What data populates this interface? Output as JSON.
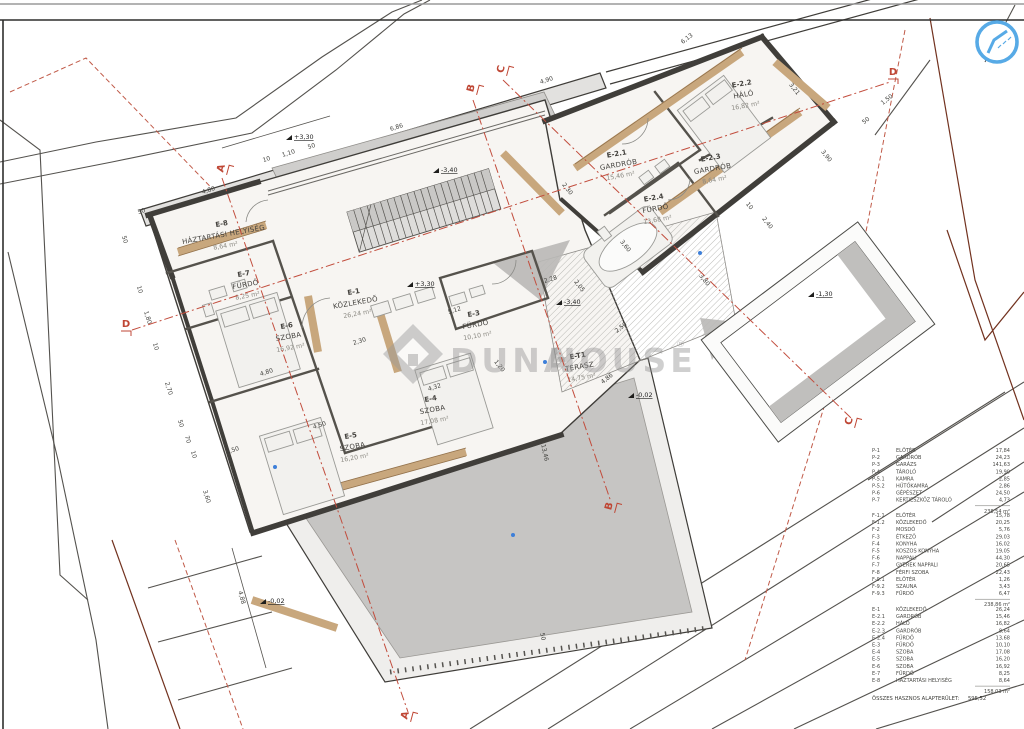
{
  "watermark": {
    "brand_left": "DUNA",
    "brand_right": "HOUSE",
    "reg": "®"
  },
  "plan": {
    "rooms": [
      {
        "id": "E-8",
        "name": "HÁZTARTÁSI HELYISÉG",
        "area": "8,64 m²",
        "x": 222,
        "y": 226,
        "rot": -10
      },
      {
        "id": "E-7",
        "name": "FÜRDŐ",
        "area": "8,25 m²",
        "x": 244,
        "y": 276,
        "rot": -10
      },
      {
        "id": "E-6",
        "name": "SZOBA",
        "area": "16,92 m²",
        "x": 287,
        "y": 328,
        "rot": -10
      },
      {
        "id": "E-1",
        "name": "KÖZLEKEDŐ",
        "area": "26,24 m²",
        "x": 354,
        "y": 294,
        "rot": -10
      },
      {
        "id": "E-3",
        "name": "FÜRDŐ",
        "area": "10,10 m²",
        "x": 474,
        "y": 316,
        "rot": -10
      },
      {
        "id": "E-4",
        "name": "SZOBA",
        "area": "17,08 m²",
        "x": 431,
        "y": 401,
        "rot": -10
      },
      {
        "id": "E-5",
        "name": "SZOBA",
        "area": "16,20 m²",
        "x": 351,
        "y": 438,
        "rot": -10
      },
      {
        "id": "E-2.1",
        "name": "GARDRÓB",
        "area": "15,46 m²",
        "x": 617,
        "y": 156,
        "rot": -10
      },
      {
        "id": "E-2.2",
        "name": "HÁLÓ",
        "area": "16,82 m²",
        "x": 742,
        "y": 86,
        "rot": -10
      },
      {
        "id": "E-2.3",
        "name": "GARDRÓB",
        "area": "8,64 m²",
        "x": 711,
        "y": 160,
        "rot": -10
      },
      {
        "id": "E-2.4",
        "name": "FÜRDŐ",
        "area": "13,68 m²",
        "x": 654,
        "y": 200,
        "rot": -10
      },
      {
        "id": "E-T1",
        "name": "TERASZ",
        "area": "14,75 m²",
        "x": 578,
        "y": 358,
        "rot": -10
      }
    ],
    "dimensions": [
      {
        "t": "4,80",
        "x": 209,
        "y": 192,
        "r": -17
      },
      {
        "t": "50",
        "x": 142,
        "y": 213,
        "r": -17
      },
      {
        "t": "50",
        "x": 123,
        "y": 240,
        "r": 73
      },
      {
        "t": "10",
        "x": 267,
        "y": 161,
        "r": -17
      },
      {
        "t": "1,10",
        "x": 289,
        "y": 155,
        "r": -17
      },
      {
        "t": "50",
        "x": 312,
        "y": 148,
        "r": -17
      },
      {
        "t": "6,86",
        "x": 397,
        "y": 129,
        "r": -17
      },
      {
        "t": "4,90",
        "x": 547,
        "y": 82,
        "r": -17
      },
      {
        "t": "6,13",
        "x": 688,
        "y": 40,
        "r": -38
      },
      {
        "t": "3,21",
        "x": 793,
        "y": 90,
        "r": 52
      },
      {
        "t": "3,90",
        "x": 825,
        "y": 157,
        "r": 52
      },
      {
        "t": "1,50",
        "x": 888,
        "y": 101,
        "r": -38
      },
      {
        "t": "50",
        "x": 867,
        "y": 122,
        "r": -38
      },
      {
        "t": "2,40",
        "x": 766,
        "y": 224,
        "r": 52
      },
      {
        "t": "10",
        "x": 748,
        "y": 207,
        "r": 52
      },
      {
        "t": "2,30",
        "x": 566,
        "y": 190,
        "r": 52
      },
      {
        "t": "3,60",
        "x": 624,
        "y": 247,
        "r": 52
      },
      {
        "t": "2,50",
        "x": 622,
        "y": 329,
        "r": -38
      },
      {
        "t": "2,28",
        "x": 551,
        "y": 281,
        "r": -17
      },
      {
        "t": "2,05",
        "x": 578,
        "y": 287,
        "r": 52
      },
      {
        "t": "3,80",
        "x": 703,
        "y": 281,
        "r": 52
      },
      {
        "t": "1,20",
        "x": 498,
        "y": 367,
        "r": 52
      },
      {
        "t": "4,86",
        "x": 608,
        "y": 380,
        "r": -38
      },
      {
        "t": "5,12",
        "x": 455,
        "y": 312,
        "r": -17
      },
      {
        "t": "4,32",
        "x": 435,
        "y": 389,
        "r": -17
      },
      {
        "t": "2,30",
        "x": 360,
        "y": 343,
        "r": -17
      },
      {
        "t": "4,80",
        "x": 267,
        "y": 374,
        "r": -17
      },
      {
        "t": "4,50",
        "x": 320,
        "y": 427,
        "r": -17
      },
      {
        "t": "1,50",
        "x": 233,
        "y": 452,
        "r": -17
      },
      {
        "t": "10",
        "x": 138,
        "y": 290,
        "r": 73
      },
      {
        "t": "1,80",
        "x": 146,
        "y": 318,
        "r": 73
      },
      {
        "t": "10",
        "x": 154,
        "y": 347,
        "r": 73
      },
      {
        "t": "2,70",
        "x": 167,
        "y": 389,
        "r": 73
      },
      {
        "t": "50",
        "x": 179,
        "y": 424,
        "r": 73
      },
      {
        "t": "70",
        "x": 186,
        "y": 440,
        "r": 73
      },
      {
        "t": "10",
        "x": 192,
        "y": 455,
        "r": 73
      },
      {
        "t": "3,60",
        "x": 205,
        "y": 497,
        "r": 73
      },
      {
        "t": "4,88",
        "x": 240,
        "y": 598,
        "r": 75
      },
      {
        "t": "13,46",
        "x": 543,
        "y": 453,
        "r": 78
      },
      {
        "t": "50",
        "x": 541,
        "y": 637,
        "r": 78
      }
    ],
    "levels": [
      {
        "t": "+3,30",
        "x": 296,
        "y": 139
      },
      {
        "t": "-3,40",
        "x": 443,
        "y": 172
      },
      {
        "t": "+3,30",
        "x": 417,
        "y": 286
      },
      {
        "t": "-3,40",
        "x": 566,
        "y": 304
      },
      {
        "t": "-0,02",
        "x": 638,
        "y": 397
      },
      {
        "t": "-0,02",
        "x": 270,
        "y": 603
      },
      {
        "t": "-1,30",
        "x": 818,
        "y": 296
      }
    ],
    "sections": [
      {
        "t": "A",
        "x": 224,
        "y": 169,
        "r": -75
      },
      {
        "t": "B",
        "x": 474,
        "y": 89,
        "r": -75
      },
      {
        "t": "C",
        "x": 504,
        "y": 70,
        "r": -75
      },
      {
        "t": "D",
        "x": 126,
        "y": 327,
        "r": 0
      },
      {
        "t": "D",
        "x": 893,
        "y": 75,
        "r": 0
      },
      {
        "t": "B",
        "x": 612,
        "y": 507,
        "r": -75
      },
      {
        "t": "C",
        "x": 852,
        "y": 422,
        "r": -75
      },
      {
        "t": "A",
        "x": 408,
        "y": 716,
        "r": -75
      }
    ]
  },
  "legend": {
    "basement": {
      "rows": [
        {
          "code": "P-1",
          "name": "ELŐTÉR",
          "value": "17,84"
        },
        {
          "code": "P-2",
          "name": "GARDRÓB",
          "value": "24,23"
        },
        {
          "code": "P-3",
          "name": "GARÁZS",
          "value": "141,63"
        },
        {
          "code": "P-4",
          "name": "TÁROLÓ",
          "value": "19,90"
        },
        {
          "code": "P-5.1",
          "name": "KAMRA",
          "value": "2,85"
        },
        {
          "code": "P-5.2",
          "name": "HŰTŐKAMRA",
          "value": "2,86"
        },
        {
          "code": "P-6",
          "name": "GÉPÉSZET",
          "value": "24,50"
        },
        {
          "code": "P-7",
          "name": "KERTIESZKÖZ TÁROLÓ",
          "value": "4,73"
        }
      ],
      "subtotal": "238,54 m²"
    },
    "ground": {
      "rows": [
        {
          "code": "F-1.1",
          "name": "ELŐTÉR",
          "value": "15,78"
        },
        {
          "code": "F-1.2",
          "name": "KÖZLEKEDŐ",
          "value": "20,25"
        },
        {
          "code": "F-2",
          "name": "MOSDÓ",
          "value": "5,76"
        },
        {
          "code": "F-3",
          "name": "ÉTKEZŐ",
          "value": "29,03"
        },
        {
          "code": "F-4",
          "name": "KONYHA",
          "value": "16,02"
        },
        {
          "code": "F-5",
          "name": "KOSZOS KONYHA",
          "value": "19,05"
        },
        {
          "code": "F-6",
          "name": "NAPPALI",
          "value": "44,30"
        },
        {
          "code": "F-7",
          "name": "GYEREK NAPPALI",
          "value": "20,65"
        },
        {
          "code": "F-8",
          "name": "FÉRFI SZOBA",
          "value": "22,43"
        },
        {
          "code": "F-9.1",
          "name": "ELŐTÉR",
          "value": "1,26"
        },
        {
          "code": "F-9.2",
          "name": "SZAUNA",
          "value": "3,43"
        },
        {
          "code": "F-9.3",
          "name": "FÜRDŐ",
          "value": "6,47"
        }
      ],
      "subtotal": "238,86 m²"
    },
    "upper": {
      "rows": [
        {
          "code": "E-1",
          "name": "KÖZLEKEDŐ",
          "value": "26,24"
        },
        {
          "code": "E-2.1",
          "name": "GARDRÓB",
          "value": "15,46"
        },
        {
          "code": "E-2.2",
          "name": "HÁLÓ",
          "value": "16,82"
        },
        {
          "code": "E-2.3",
          "name": "GARDRÓB",
          "value": "8,64"
        },
        {
          "code": "E-2.4",
          "name": "FÜRDŐ",
          "value": "13,68"
        },
        {
          "code": "E-3",
          "name": "FÜRDŐ",
          "value": "10,10"
        },
        {
          "code": "E-4",
          "name": "SZOBA",
          "value": "17,08"
        },
        {
          "code": "E-5",
          "name": "SZOBA",
          "value": "16,20"
        },
        {
          "code": "E-6",
          "name": "SZOBA",
          "value": "16,92"
        },
        {
          "code": "E-7",
          "name": "FÜRDŐ",
          "value": "8,25"
        },
        {
          "code": "E-8",
          "name": "HÁZTARTÁSI HELYISÉG",
          "value": "8,64"
        }
      ],
      "subtotal": "158,03 m²"
    },
    "total_label": "ÖSSZES HASZNOS ALAPTERÜLET:",
    "total_value": "595,52"
  }
}
